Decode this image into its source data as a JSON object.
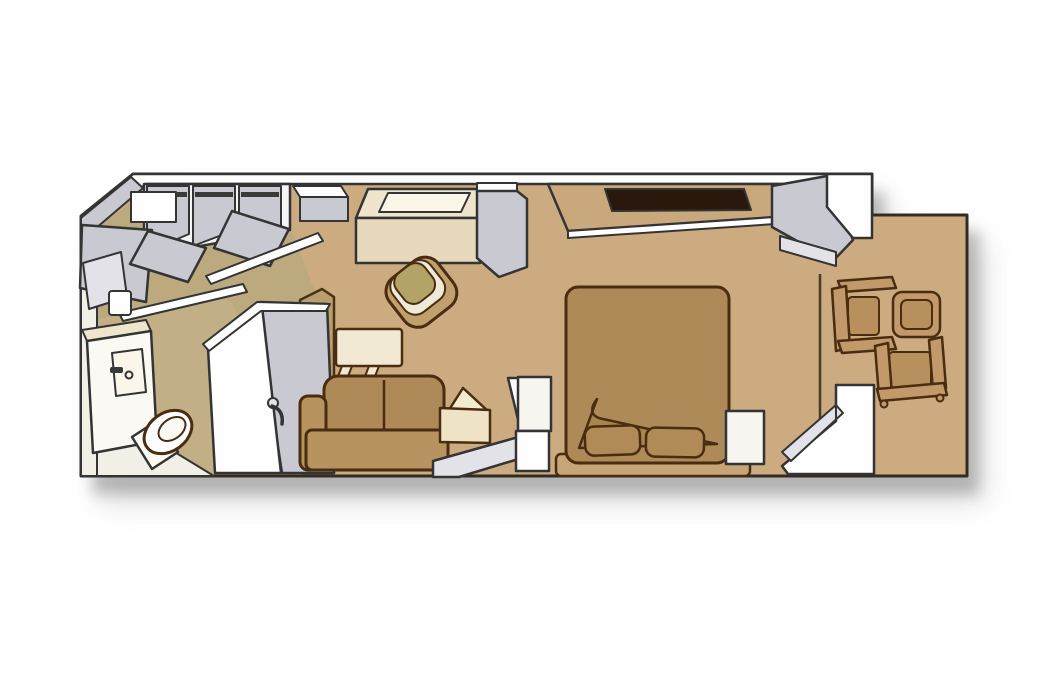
{
  "floorplan": {
    "kind": "isometric-stateroom-floorplan",
    "rooms": [
      "entry",
      "bathroom",
      "sitting-area",
      "bedroom",
      "balcony"
    ],
    "furniture": [
      "closet-bays",
      "closet-rails",
      "open-closet-doors",
      "safe",
      "desk",
      "desk-top-inset",
      "desk-chair",
      "window",
      "interior-wall",
      "bathroom-door",
      "shower-stall",
      "shower-door-handle",
      "vanity-sink-cabinet",
      "toilet",
      "tv",
      "sofa",
      "floor-lamp",
      "side-table",
      "partition-wall",
      "bed",
      "pillow-left",
      "pillow-right",
      "turned-down-sheet",
      "headboard",
      "nightstand-left",
      "nightstand-right",
      "balcony-divider",
      "sliding-door-track",
      "balcony-chair-top",
      "balcony-chair-bottom",
      "balcony-table"
    ]
  },
  "colors": {
    "background": "#ffffff",
    "shadow1": "#8f8f8f",
    "shadow2": "#b5b5b5",
    "floor": "#cbab7f",
    "floor_entry": "#b3a97c",
    "floor_bath": "#c3b088",
    "wall_white": "#fefefe",
    "wall_offwhite": "#f4f4f6",
    "wall_gray": "#c9c9d1",
    "wall_gray_light": "#e2e2e8",
    "wall_cream": "#f2efe6",
    "rail": "#3a3a3a",
    "interior_wall_tan": "#bb9e70",
    "window_wall_tan": "#c9a97c",
    "window_dark": "#2a180c",
    "cream": "#efe5cc",
    "cream_light": "#faf6ea",
    "cream_mid": "#e7d9bc",
    "white_fixture": "#fbf9f3",
    "tv": "#f1e9d3",
    "sofa": "#b6935f",
    "sofa_back": "#ad8a58",
    "bed": "#ad8a58",
    "bed_dark": "#a8854f",
    "headboard": "#c7a577",
    "pillow": "#b08b58",
    "nightstand": "#f7f5ef",
    "side_table": "#efe3c6",
    "table_lamp": "#f3ead2",
    "chair_shell": "#c0a06c",
    "chair_ring": "#efe9d8",
    "chair_seat": "#b3a369",
    "balcony_furniture": "#c1996a",
    "balcony_seat": "#b8905e",
    "seam": "#4a3a26"
  }
}
